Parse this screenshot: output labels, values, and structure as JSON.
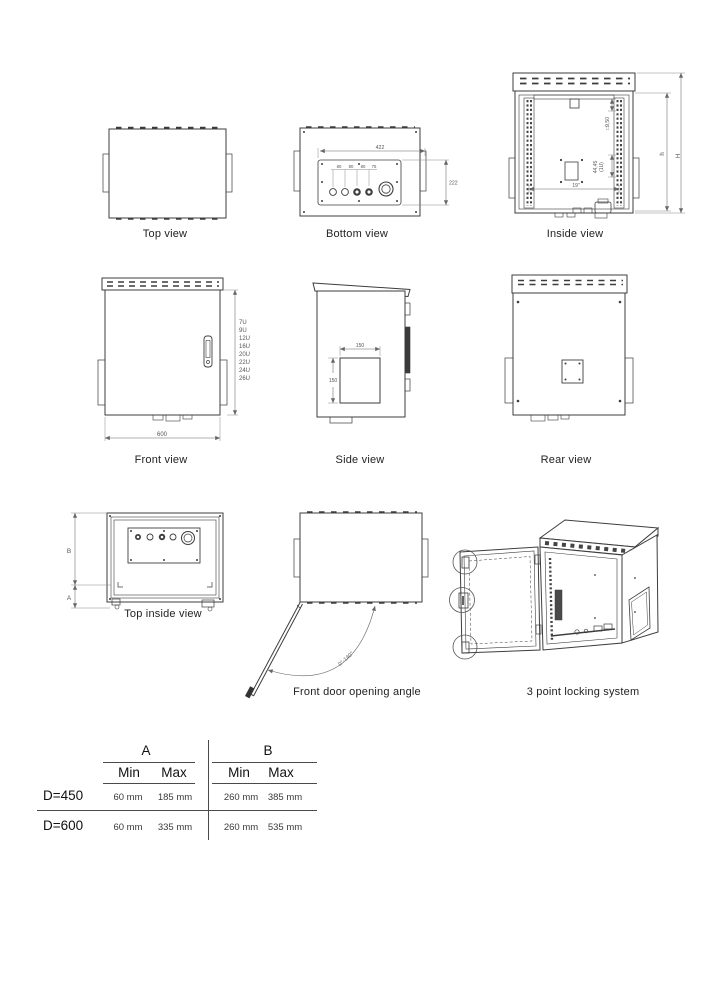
{
  "views": {
    "top": {
      "caption": "Top view"
    },
    "bottom": {
      "caption": "Bottom view",
      "dims": {
        "width": "422",
        "height": "222",
        "holes": [
          "80",
          "80",
          "80",
          "75"
        ]
      }
    },
    "inside": {
      "caption": "Inside view",
      "dims": {
        "hole": "□9,50",
        "pitch": "44,45",
        "pitch2": "(1U)",
        "rack": "19\"",
        "h": "h",
        "H": "H"
      }
    },
    "front": {
      "caption": "Front view",
      "dims": {
        "width": "600",
        "units": [
          "7U",
          "9U",
          "12U",
          "16U",
          "20U",
          "22U",
          "24U",
          "26U"
        ]
      }
    },
    "side": {
      "caption": "Side view",
      "dims": {
        "cutout_w": "150",
        "cutout_h": "150"
      }
    },
    "rear": {
      "caption": "Rear view"
    },
    "top_inside": {
      "caption": "Top inside view",
      "dims": {
        "b": "B",
        "a": "A"
      }
    },
    "door": {
      "caption": "Front door opening angle",
      "dims": {
        "angle": "0°-140°"
      }
    },
    "locking": {
      "caption": "3 point locking system"
    }
  },
  "table": {
    "groups": [
      {
        "label": "A"
      },
      {
        "label": "B"
      }
    ],
    "subheaders": [
      "Min",
      "Max",
      "Min",
      "Max"
    ],
    "rows": [
      {
        "label": "D=450",
        "values": [
          "60 mm",
          "185 mm",
          "260 mm",
          "385 mm"
        ]
      },
      {
        "label": "D=600",
        "values": [
          "60 mm",
          "335 mm",
          "260 mm",
          "535 mm"
        ]
      }
    ]
  }
}
